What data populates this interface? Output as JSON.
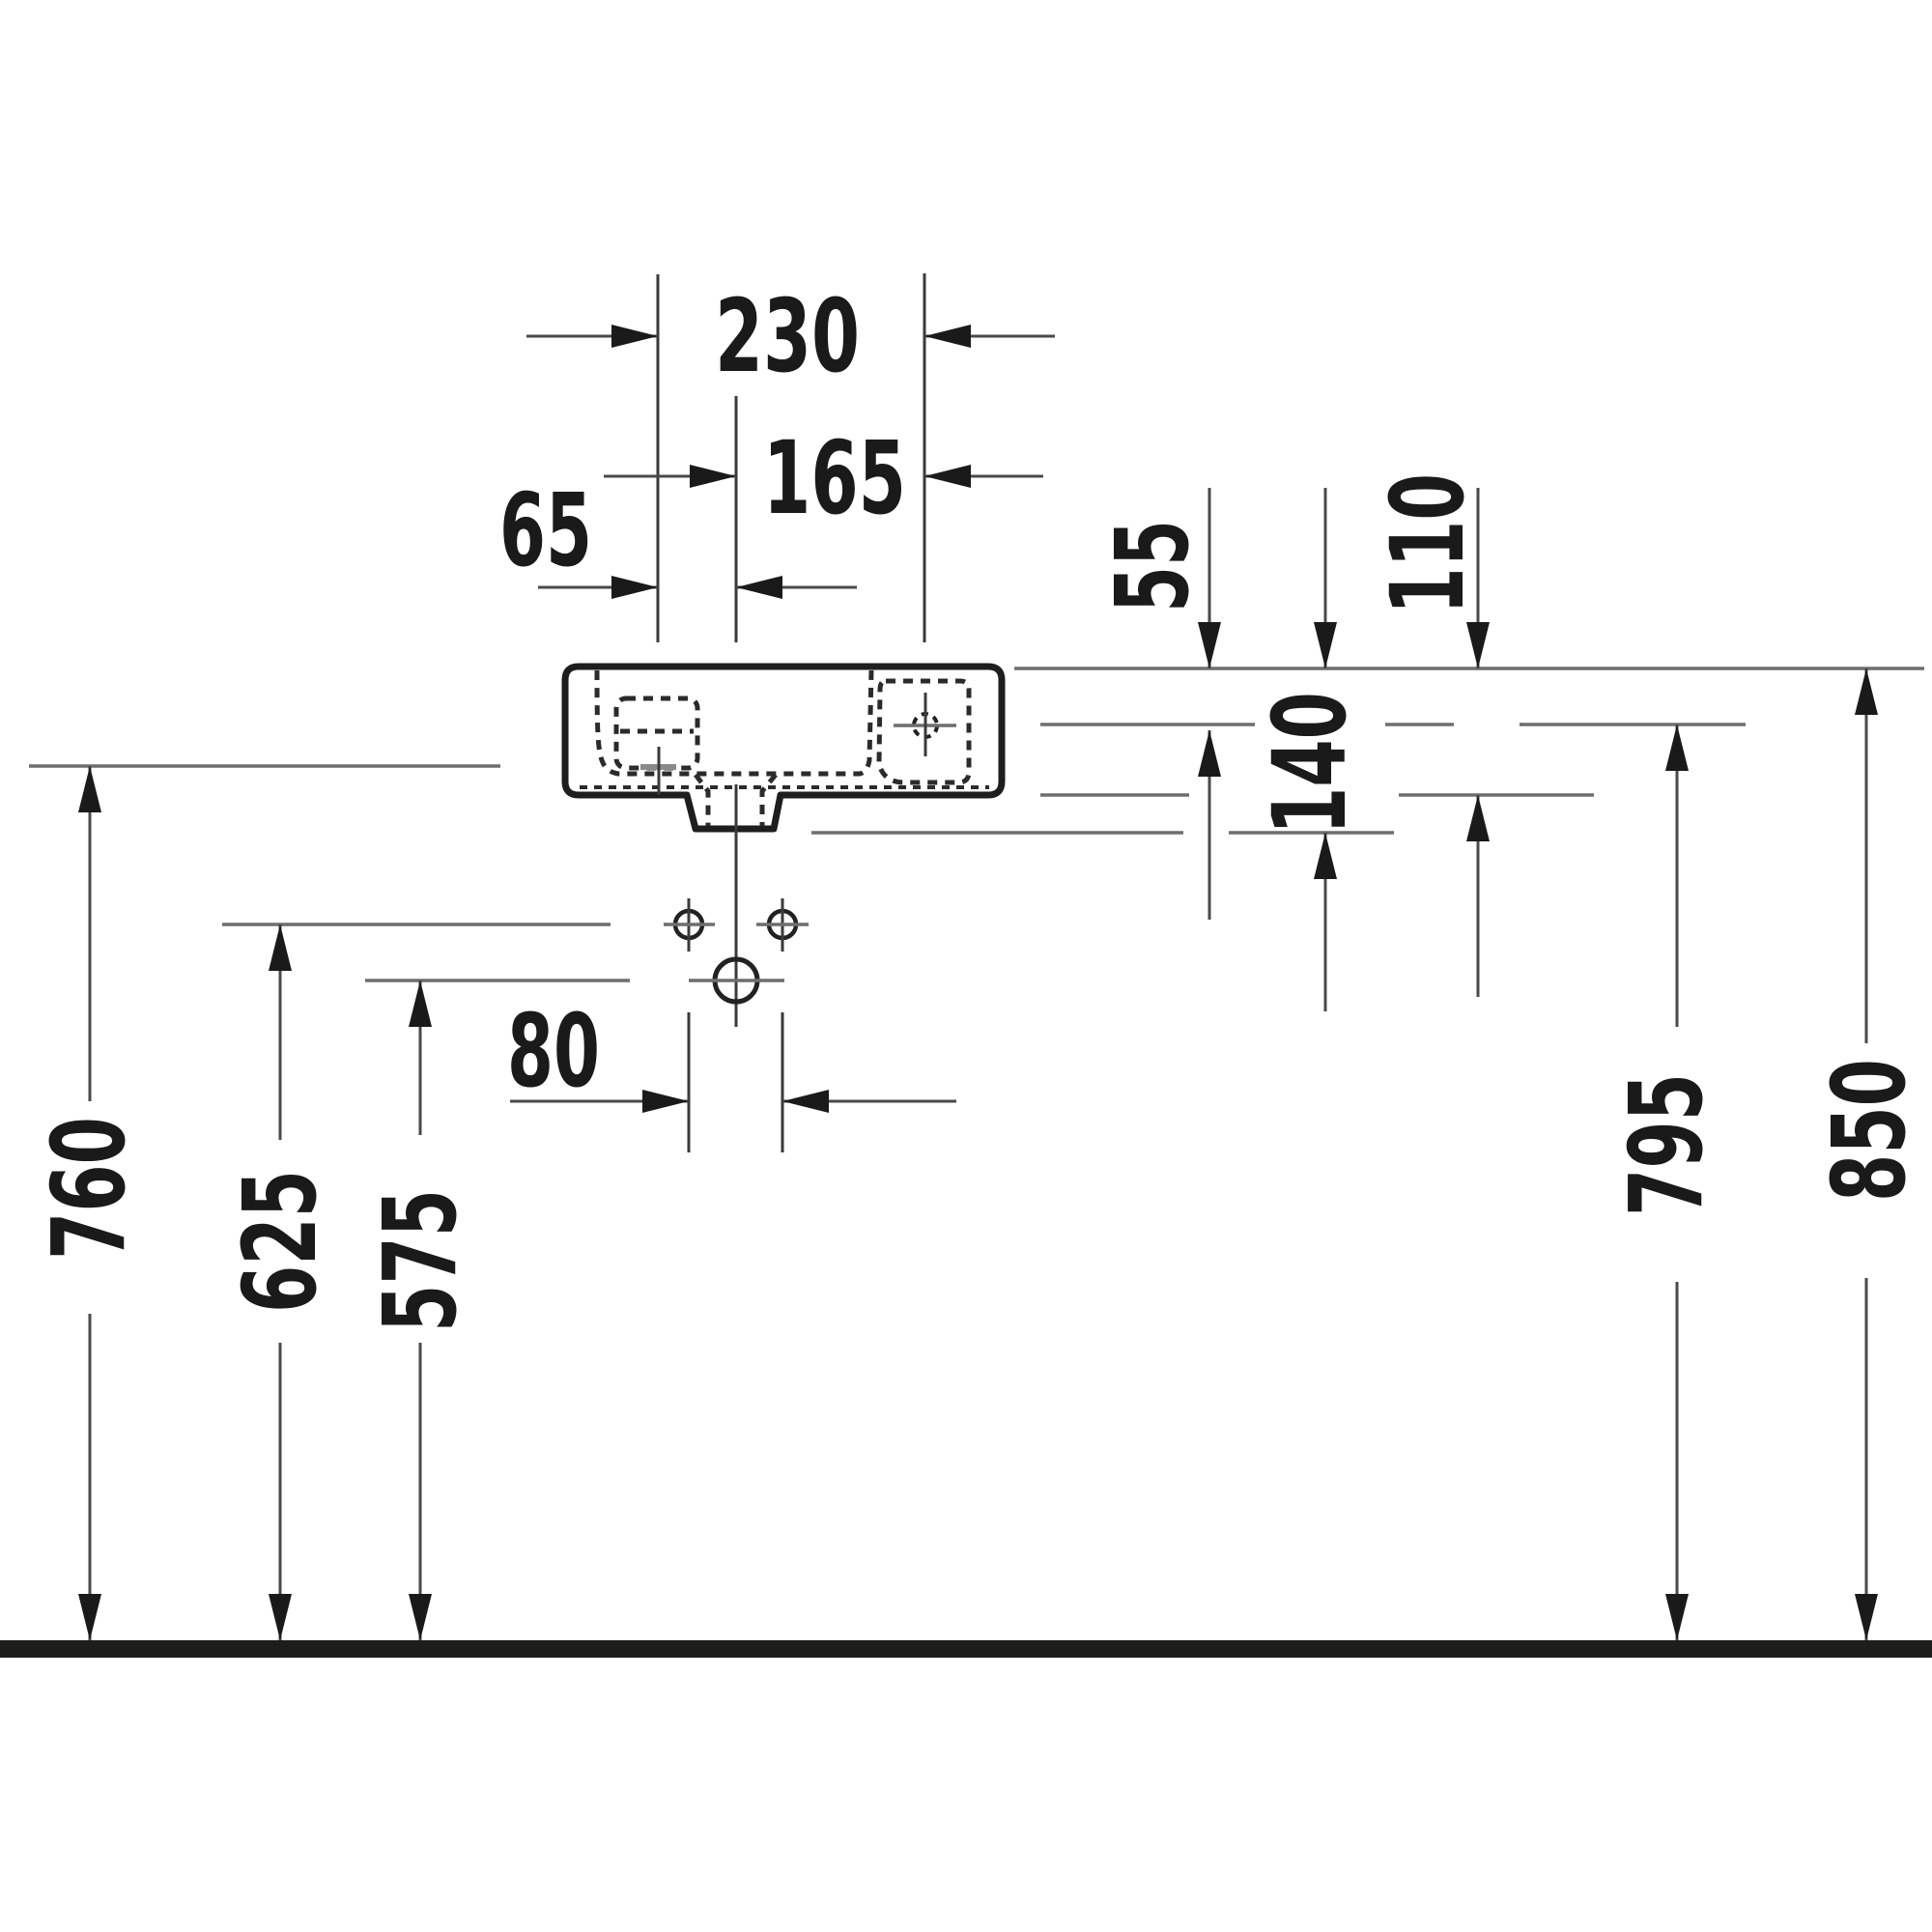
{
  "drawing": {
    "description": "Technical dimension drawing, wall-mounted hand-rinse basin, front elevation with installation dimensions",
    "units": "mm",
    "colors": {
      "ink": "#1a1a1a",
      "thin_line": "#3a3a3a",
      "arrow_shaft": "#4a4a4a",
      "reference_gray": "#6e6e6e",
      "tap_mark_gray": "#8a8a8a",
      "floor": "#1d1d1b",
      "background": "#ffffff"
    },
    "dims": {
      "d230": "230",
      "d165": "165",
      "d65": "65",
      "d55": "55",
      "d110": "110",
      "d140": "140",
      "d80": "80",
      "d760": "760",
      "d625": "625",
      "d575": "575",
      "d795": "795",
      "d850": "850"
    }
  }
}
